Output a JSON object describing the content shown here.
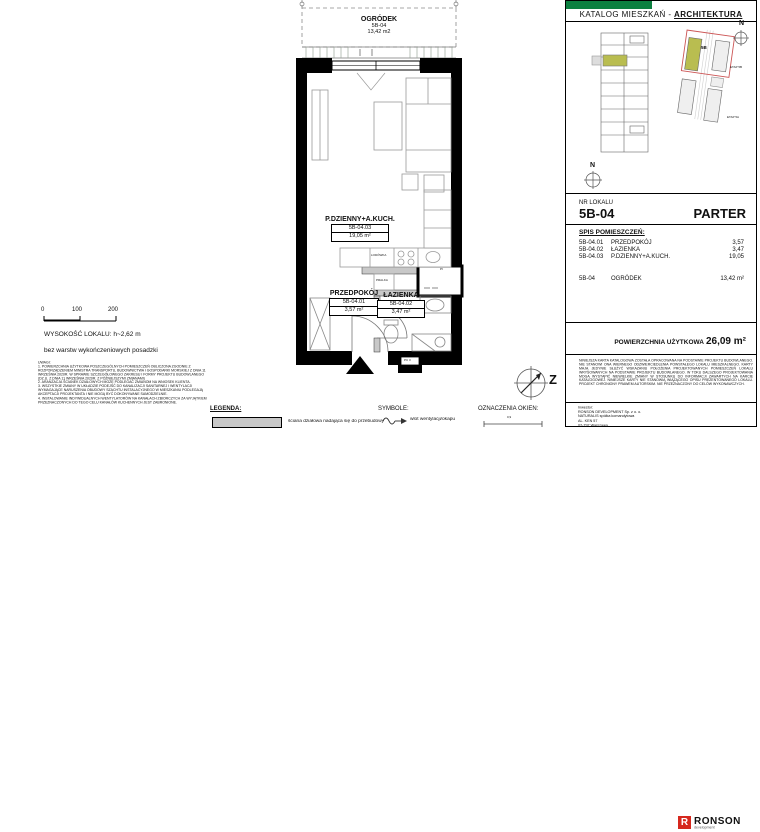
{
  "header": {
    "title_prefix": "KATALOG MIESZKAŃ - ",
    "title_emphasis": "ARCHITEKTURA"
  },
  "unit": {
    "nr_label": "NR LOKALU",
    "number": "5B-04",
    "floor": "PARTER"
  },
  "site": {
    "unit_label": "5B",
    "stage_top": "ETAP 5B",
    "stage_bottom": "ETAP 5A",
    "north": "N"
  },
  "rooms": {
    "title": "SPIS POMIESZCZEŃ:",
    "items": [
      {
        "code": "5B-04.01",
        "name": "PRZEDPOKÓJ",
        "area": "3,57"
      },
      {
        "code": "5B-04.02",
        "name": "ŁAZIENKA",
        "area": "3,47"
      },
      {
        "code": "5B-04.03",
        "name": "P.DZIENNY+A.KUCH.",
        "area": "19,05"
      }
    ],
    "garden": {
      "code": "5B-04",
      "name": "OGRÓDEK",
      "area": "13,42 m²"
    }
  },
  "summary": {
    "label": "POWIERZCHNIA UŻYTKOWA",
    "value": "26,09 m²"
  },
  "disclaimer": "NINIEJSZA KARTA KATALOGOWA ZOSTAŁA OPRACOWANA NA PODSTAWIE PROJEKTU BUDOWLANEGO. NIE STANOWI ONA WIERNEGO ODZWIERCIEDLENIA POWSTAŁEGO LOKALU MIESZKALNEGO. KARTY MAJĄ JEDYNIE SŁUŻYĆ WSKAZANIU POŁOŻENIA PROJEKTOWANYCH POMIESZCZEŃ LOKALU WRYSOWANYCH NA PODSTAWIE PROJEKTU BUDOWLANEGO. W TOKU DALSZEGO PROJEKTOWANIA MOGĄ WYSTĄPIĆ NIEWIELKIE ZMIANY W STOSUNKU DO INFORMACJI ZAWARTYCH NA KARCIE KATALOGOWEJ. NINIEJSZE KARTY NIE STANOWIĄ WIĄŻĄCEGO OPISU PREZENTOWANEGO LOKALU. PROJEKT CHRONIONY PRAWEM AUTORSKIM. NIE PRZEZNACZONY DO CELÓW WYKONAWCZYCH.",
  "investor": {
    "label": "Inwestor:",
    "line1": "RONSON DEVELOPMENT Sp. z o. o.",
    "line2": "NATURALIS spółka komandytowa",
    "line3": "AL. KEN 57",
    "line4": "02-797 Warszawa",
    "logo_letter": "R",
    "logo": "RONSON",
    "logo_sub": "development"
  },
  "plan": {
    "garden_name": "OGRÓDEK",
    "garden_code": "5B-04",
    "garden_area": "13,42 m2",
    "living_name": "P.DZIENNY+A.KUCH.",
    "living_code": "5B-04.03",
    "living_area": "19,05 m²",
    "hall_name": "PRZEDPOKÓJ",
    "hall_code": "5B-04.01",
    "hall_area": "3,57 m²",
    "bath_name": "ŁAZIENKA",
    "bath_code": "5B-04.02",
    "bath_area": "3,47 m²",
    "fridge": "LODÓWKA",
    "washer": "PRALKA",
    "shaft": "PI",
    "door_code": "PC 3",
    "compass_west": "Z"
  },
  "notes": {
    "scale": [
      "0",
      "100",
      "200"
    ],
    "height": "WYSOKOŚĆ LOKALU: h~2,62 m",
    "floor_note": "bez warstw wykończeniowych posadzki",
    "uwagi_title": "UWAGI:",
    "uwagi_1": "1. POWIERZCHNIA UŻYTKOWA POSZCZEGÓLNYCH POMIESZCZEŃ OBLICZONA ZGODNIE Z ROZPORZĄDZENIEM MINISTRA TRANSPORTU, BUDOWNICTWA I GOSPODARKI MORSKIEJ Z DNIA 11 WRZEŚNIA 2020R. W SPRAWIE SZCZEGÓŁOWEGO ZAKRESU I FORMY PROJEKTU BUDOWLANEGO (DZ.U. Z DNIA 11 WRZEŚNIA 2020R. Z PÓŹNIEJSZYMI ZMIANAMI)",
    "uwagi_2": "2. ARANŻACJA ŚCIANEK DZIAŁOWYCH MOŻE PODLEGAĆ ZMIANOM NA WNIOSEK KLIENTA.",
    "uwagi_3": "3. WSZYSTKIE ZMIANY W UKŁADZIE PODEJŚĆ DO KANALIZACJI SANITARNEJ I WENTYLACJI WYMAGAJĄCE NARUSZENIA OBUDOWY SZACHTU INSTALACYJNEGO W MIESZKANIU PODLEGAJĄ AKCEPTACJI PROJEKTANTA I NIE MOGĄ BYĆ DOKONYWANE SAMODZIELNIE.",
    "uwagi_4": "4. INSTALOWANIE INDYWIDUALNYCH WENTYLATORÓW NA KANAŁACH ZBIORCZYCH ZA WYJĄTKIEM PRZEZNACZONYCH DO TEGO CELU KANAŁÓW KUCHENNYCH JEST ZABRONIONE."
  },
  "legend": {
    "title": "LEGENDA:",
    "wall_label": "ściana działowa nadająca się do przebudowy",
    "symbols_title": "SYMBOLE:",
    "vent_label": "wlot wentylacji/okapu",
    "windows_title": "OZNACZENIA OKIEN:",
    "window_dim": "0,9"
  },
  "colors": {
    "brand_green": "#0c8040",
    "highlight_olive": "#b9bd50",
    "logo_red": "#d6281e",
    "boundary_red": "#cc5555"
  }
}
